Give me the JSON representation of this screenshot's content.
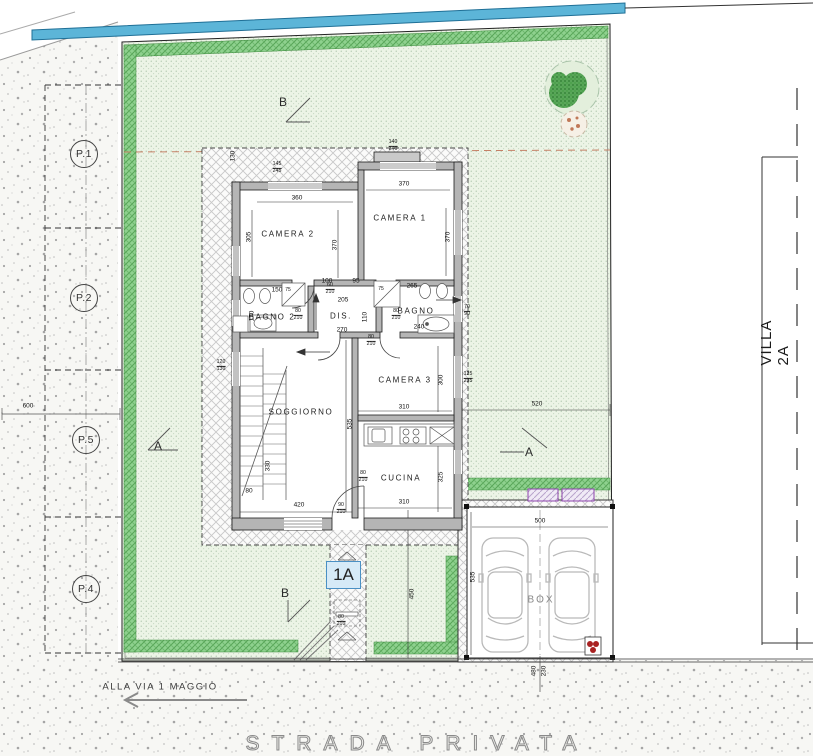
{
  "site": {
    "street_name": "STRADA PRIVATA",
    "street_direction": "ALLA VIA 1 MAGGIO",
    "villa_label": "VILLA 2A",
    "unit_label": "1A",
    "box_label": "BOX"
  },
  "colors": {
    "garden_green": "#ecf4e6",
    "garden_border_green": "#8ed18e",
    "pool_edge_blue": "#5cb5d8",
    "wall_gray": "#b5b5b5",
    "paving_line_gray": "#c8c8c8",
    "boundary_red_dash": "#c58066",
    "accent_purple": "#8e44ad",
    "unit_box_blue": "#4a90c4",
    "hydrant_red": "#a92222",
    "road_speckle": "#a5a5a5"
  },
  "rooms": [
    {
      "label": "CAMERA 2",
      "x": 288,
      "y": 234
    },
    {
      "label": "CAMERA 1",
      "x": 400,
      "y": 218
    },
    {
      "label": "BAGNO 2",
      "x": 272,
      "y": 317
    },
    {
      "label": "DIS.",
      "x": 341,
      "y": 316
    },
    {
      "label": "BAGNO",
      "x": 416,
      "y": 311
    },
    {
      "label": "SOGGIORNO",
      "x": 301,
      "y": 412
    },
    {
      "label": "CAMERA 3",
      "x": 405,
      "y": 380
    },
    {
      "label": "CUCINA",
      "x": 401,
      "y": 478
    }
  ],
  "dims": [
    {
      "t": "600",
      "x": 28,
      "y": 406,
      "r": 0
    },
    {
      "t": "130",
      "x": 233,
      "y": 156,
      "r": -90
    },
    {
      "t": "360",
      "x": 297,
      "y": 198,
      "r": 0
    },
    {
      "t": "305",
      "x": 249,
      "y": 237,
      "r": -90
    },
    {
      "t": "370",
      "x": 404,
      "y": 184,
      "r": 0
    },
    {
      "t": "370",
      "x": 448,
      "y": 237,
      "r": -90
    },
    {
      "t": "370",
      "x": 335,
      "y": 245,
      "r": -90
    },
    {
      "t": "100",
      "x": 327,
      "y": 281,
      "r": 0
    },
    {
      "t": "95",
      "x": 356,
      "y": 281,
      "r": 0
    },
    {
      "t": "205",
      "x": 343,
      "y": 300,
      "r": 0
    },
    {
      "t": "110",
      "x": 365,
      "y": 317,
      "r": -90
    },
    {
      "t": "270",
      "x": 342,
      "y": 330,
      "r": 0
    },
    {
      "t": "265",
      "x": 412,
      "y": 286,
      "r": 0
    },
    {
      "t": "240",
      "x": 419,
      "y": 327,
      "r": 0
    },
    {
      "t": "170",
      "x": 252,
      "y": 316,
      "r": -90
    },
    {
      "t": "150",
      "x": 277,
      "y": 290,
      "r": 0
    },
    {
      "t": "75",
      "x": 288,
      "y": 290,
      "r": 0,
      "s": 1
    },
    {
      "t": "75",
      "x": 381,
      "y": 289,
      "r": 0,
      "s": 1
    },
    {
      "t": "520",
      "x": 537,
      "y": 404,
      "r": 0
    },
    {
      "t": "310",
      "x": 404,
      "y": 407,
      "r": 0
    },
    {
      "t": "300",
      "x": 441,
      "y": 380,
      "r": -90
    },
    {
      "t": "310",
      "x": 404,
      "y": 502,
      "r": 0
    },
    {
      "t": "325",
      "x": 441,
      "y": 477,
      "r": -90
    },
    {
      "t": "420",
      "x": 299,
      "y": 505,
      "r": 0
    },
    {
      "t": "535",
      "x": 350,
      "y": 424,
      "r": -90
    },
    {
      "t": "330",
      "x": 268,
      "y": 466,
      "r": -90
    },
    {
      "t": "80",
      "x": 249,
      "y": 491,
      "r": 0
    },
    {
      "t": "500",
      "x": 540,
      "y": 521,
      "r": 0
    },
    {
      "t": "535",
      "x": 473,
      "y": 577,
      "r": -90
    },
    {
      "t": "450",
      "x": 412,
      "y": 594,
      "r": -90
    },
    {
      "t": "480",
      "x": 534,
      "y": 671,
      "r": -90
    },
    {
      "t": "230",
      "x": 544,
      "y": 671,
      "r": -90
    }
  ],
  "pair_dims": [
    {
      "a": "140",
      "b": "240",
      "x": 393,
      "y": 146
    },
    {
      "a": "145",
      "b": "245",
      "x": 277,
      "y": 168
    },
    {
      "a": "80",
      "b": "210",
      "x": 298,
      "y": 315
    },
    {
      "a": "80",
      "b": "210",
      "x": 396,
      "y": 315
    },
    {
      "a": "60",
      "b": "210",
      "x": 330,
      "y": 289
    },
    {
      "a": "80",
      "b": "210",
      "x": 371,
      "y": 341
    },
    {
      "a": "90",
      "b": "210",
      "x": 341,
      "y": 509
    },
    {
      "a": "80",
      "b": "210",
      "x": 363,
      "y": 477
    },
    {
      "a": "120",
      "b": "130",
      "x": 221,
      "y": 366
    },
    {
      "a": "125",
      "b": "235",
      "x": 468,
      "y": 378
    },
    {
      "a": "70",
      "b": "90",
      "x": 467,
      "y": 311
    },
    {
      "a": "80",
      "b": "210",
      "x": 341,
      "y": 621
    }
  ],
  "section_markers": [
    {
      "t": "B",
      "x": 283,
      "y": 102
    },
    {
      "t": "B",
      "x": 285,
      "y": 593
    },
    {
      "t": "A",
      "x": 158,
      "y": 446
    },
    {
      "t": "A",
      "x": 529,
      "y": 452
    }
  ],
  "parking_spots": [
    {
      "label": "P.1",
      "x": 84,
      "y": 154
    },
    {
      "label": "P.2",
      "x": 84,
      "y": 298
    },
    {
      "label": "P.5",
      "x": 86,
      "y": 440
    },
    {
      "label": "P.4",
      "x": 86,
      "y": 589
    }
  ],
  "box": {
    "pos_x": 541,
    "pos_y": 600
  }
}
